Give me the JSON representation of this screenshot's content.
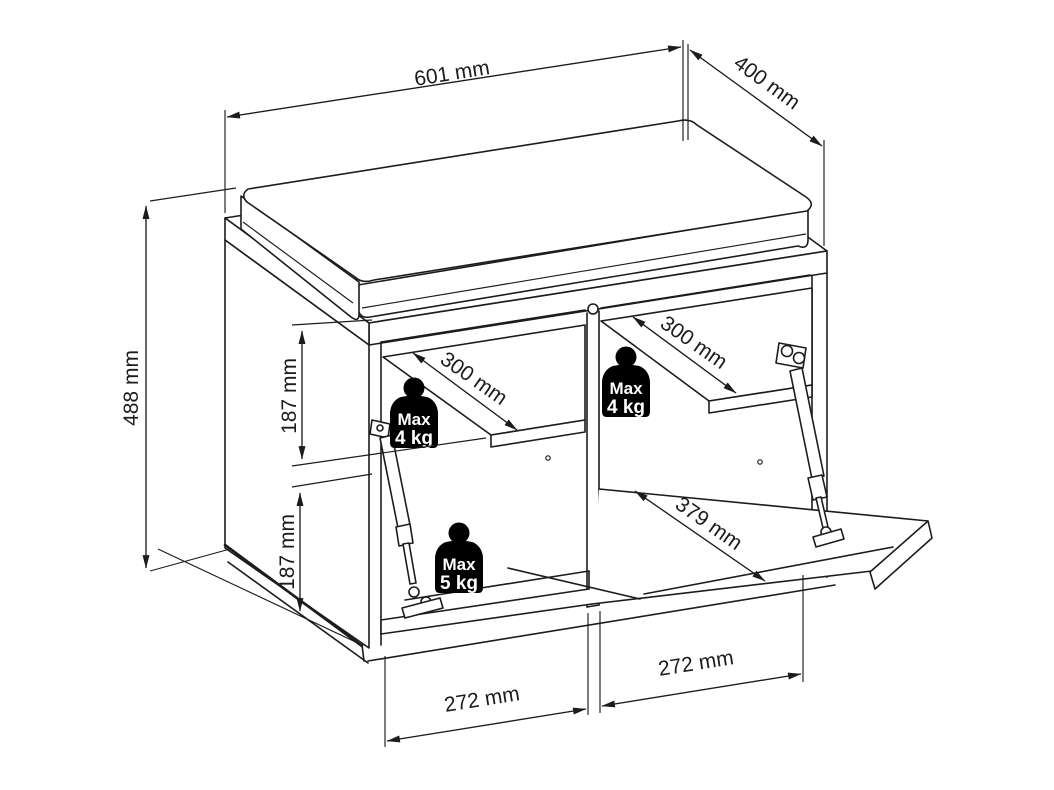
{
  "drawing": {
    "background": "#ffffff",
    "line_color": "#1c1c1c",
    "labels": {
      "width": "601 mm",
      "depth": "400 mm",
      "height": "488 mm",
      "upper_compartment_height": "187 mm",
      "lower_compartment_height": "187 mm",
      "left_shelf_depth": "300 mm",
      "right_shelf_depth": "300 mm",
      "flap_door_length": "379 mm",
      "left_bay_width": "272 mm",
      "right_bay_width": "272 mm"
    },
    "load_badges": {
      "left_shelf": {
        "line1": "Max",
        "line2": "4 kg"
      },
      "right_shelf": {
        "line1": "Max",
        "line2": "4 kg"
      },
      "flap_door": {
        "line1": "Max",
        "line2": "5 kg"
      }
    },
    "badge_colors": {
      "bg": "#000000",
      "text": "#ffffff"
    }
  }
}
